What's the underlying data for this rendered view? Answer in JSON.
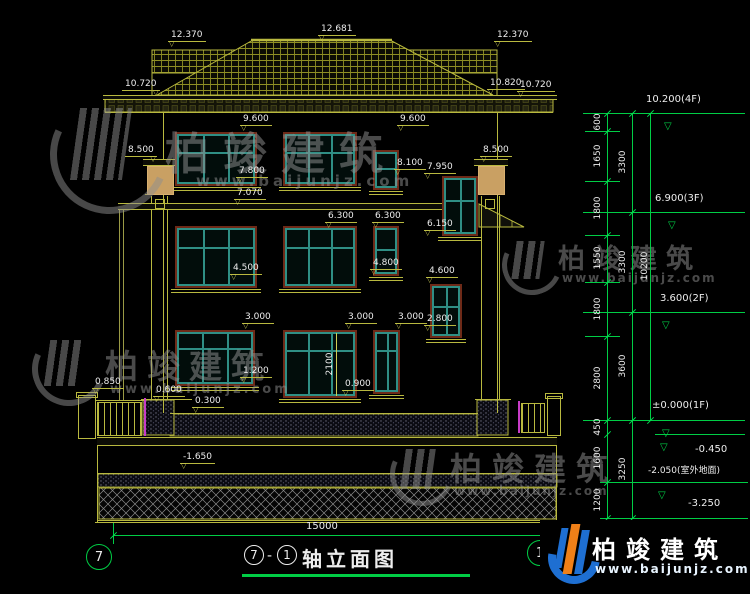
{
  "drawing": {
    "title": {
      "bubble_left": "7",
      "dash": "-",
      "bubble_right": "1",
      "text": "轴立面图"
    },
    "axis_bubbles": {
      "left": "7",
      "right": "1"
    },
    "total_width_dim": "15000",
    "window_height_dim": "2100"
  },
  "roof": {
    "ridge": "12.681",
    "left_top": "12.370",
    "right_top": "12.370",
    "eave_left": "10.720",
    "eave_right_a": "10.820",
    "eave_right_b": "10.720"
  },
  "levels": {
    "col_left": "8.500",
    "col_right": "8.500",
    "f3_a": "9.600",
    "f3_b": "9.600",
    "f3_small": "8.100",
    "bay_top": "7.950",
    "f3_sill": "7.800",
    "porch": "7.070",
    "f2_a": "6.300",
    "f2_b": "6.300",
    "bay_mid": "6.150",
    "f2_sill": "4.500",
    "f2_small": "4.800",
    "bay2_top": "4.600",
    "f1_a": "3.000",
    "f1_b": "3.000",
    "f1_c": "3.000",
    "bay2_sill": "2.800",
    "f1_sill_a": "1.200",
    "f1_sill_b": "0.900",
    "fence": "0.850",
    "ledge": "0.600",
    "terrace": "0.300",
    "basement": "-1.650"
  },
  "markers": {
    "m4f": "10.200(4F)",
    "m3f": "6.900(3F)",
    "m2f": "3.600(2F)",
    "m1f": "±0.000(1F)",
    "m045": "-0.450",
    "m205": "-2.050(室外地面)",
    "m325": "-3.250"
  },
  "dims": {
    "a": [
      "600",
      "1650",
      "1800",
      "1550",
      "1800",
      "2800",
      "450",
      "1600",
      "1200"
    ],
    "b": [
      "3300",
      "3300",
      "3600",
      "3250"
    ],
    "c": [
      "10200"
    ]
  },
  "brand": {
    "name": "柏竣建筑",
    "url": "www.baijunjz.com"
  },
  "colors": {
    "background": "#000000",
    "cad_line": "#b9b93f",
    "dim_green": "#00cd45",
    "window_teal": "#2f8f85",
    "window_casing": "#6e2a18",
    "text": "#ededed",
    "magenta": "#c83cc8",
    "capital_tan": "#c9a063",
    "watermark_gray": "#8f8f8f",
    "logo_blue": "#1e6fd2",
    "logo_orange": "#f08018"
  }
}
